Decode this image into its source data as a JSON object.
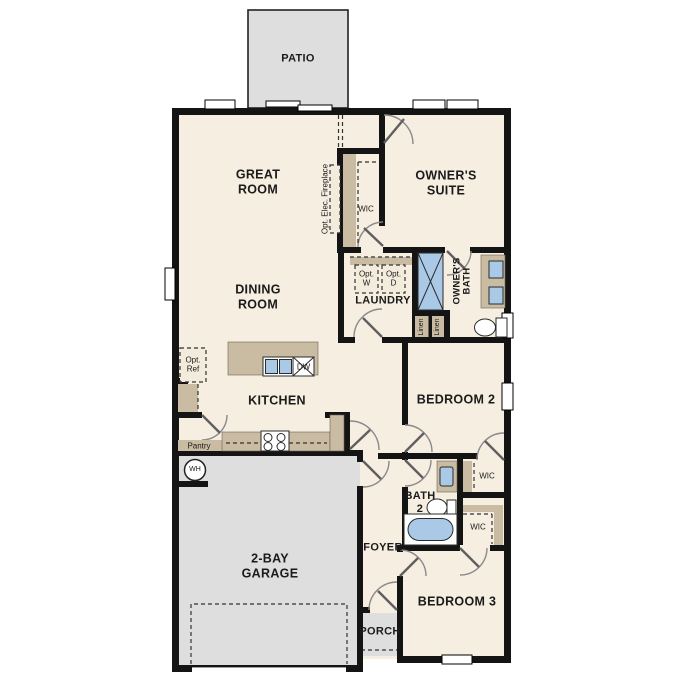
{
  "title": "single-story floor plan",
  "labels": {
    "patio": "PATIO",
    "great_room": "GREAT\nROOM",
    "owners_suite": "OWNER'S\nSUITE",
    "opt_fireplace": "Opt. Elec. Fireplace",
    "owners_wic": "WIC",
    "dining_room": "DINING\nROOM",
    "laundry": "LAUNDRY",
    "opt_washer": "Opt.\nW",
    "opt_dryer": "Opt.\nD",
    "owners_bath": "OWNER'S\nBATH",
    "linen_left": "Linen",
    "linen_right": "Linen",
    "opt_ref": "Opt.\nRef",
    "kitchen": "KITCHEN",
    "dishwasher": "DW",
    "bedroom2": "BEDROOM 2",
    "pantry": "Pantry",
    "water_heater": "WH",
    "bath2": "BATH\n2",
    "wic_bedroom2": "WIC",
    "wic_bedroom3": "WIC",
    "garage": "2-BAY\nGARAGE",
    "foyer": "FOYER",
    "bedroom3": "BEDROOM 3",
    "porch": "PORCH"
  },
  "colors": {
    "wall": "#141414",
    "floor": "#f5eee1",
    "tan": "#c9bca2",
    "fixture_blue": "#aac9e6",
    "concrete": "#dedede"
  }
}
